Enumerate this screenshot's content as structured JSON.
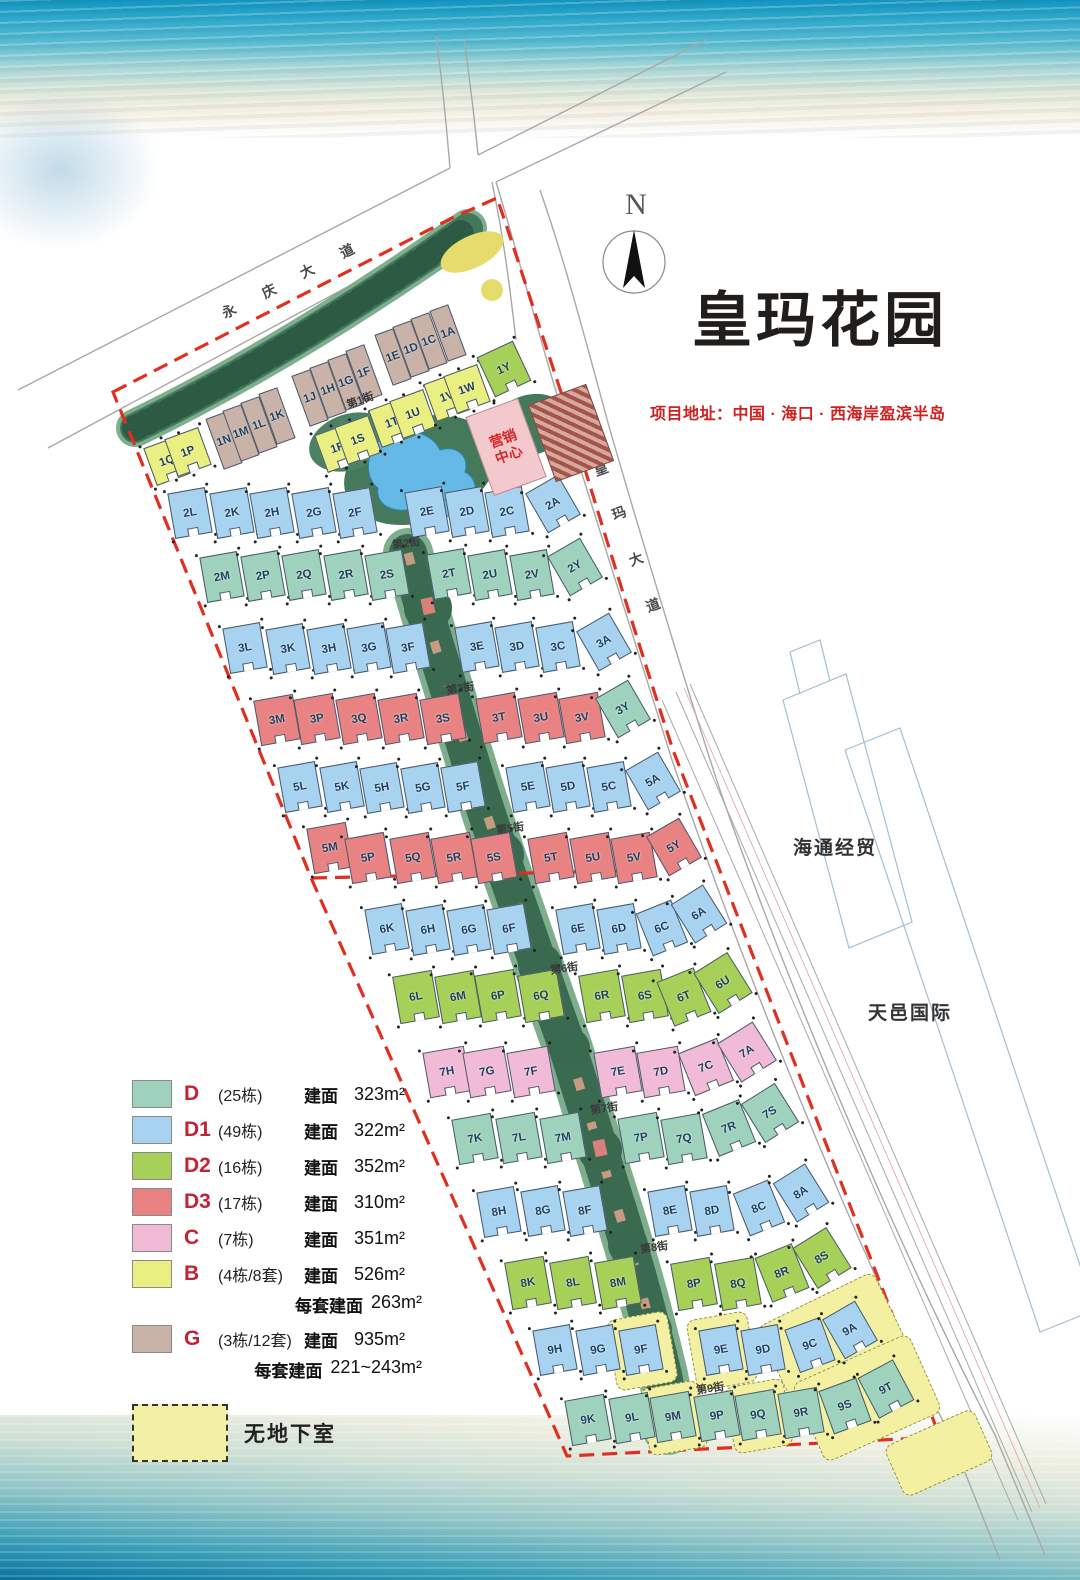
{
  "title": "皇玛花园",
  "address": "项目地址：中国 · 海口 · 西海岸盈滨半岛",
  "compass": {
    "north_label": "N"
  },
  "roads": {
    "yongqing_avenue": "永庆大道",
    "huangma_avenue": "皇玛大道"
  },
  "road_chars": [
    {
      "c": "永",
      "x": 230,
      "y": 310,
      "r": -27
    },
    {
      "c": "庆",
      "x": 270,
      "y": 290,
      "r": -27
    },
    {
      "c": "大",
      "x": 308,
      "y": 270,
      "r": -27
    },
    {
      "c": "道",
      "x": 348,
      "y": 250,
      "r": -27
    },
    {
      "c": "皇",
      "x": 602,
      "y": 468,
      "r": -20
    },
    {
      "c": "玛",
      "x": 620,
      "y": 512,
      "r": -20
    },
    {
      "c": "大",
      "x": 637,
      "y": 558,
      "r": -20
    },
    {
      "c": "道",
      "x": 654,
      "y": 604,
      "r": -20
    }
  ],
  "streets": [
    {
      "name": "第1街",
      "x": 362,
      "y": 400,
      "r": -20
    },
    {
      "name": "第2街",
      "x": 408,
      "y": 543,
      "r": -8
    },
    {
      "name": "第3街",
      "x": 462,
      "y": 688,
      "r": -8
    },
    {
      "name": "第5街",
      "x": 512,
      "y": 828,
      "r": -8
    },
    {
      "name": "第6街",
      "x": 566,
      "y": 968,
      "r": -8
    },
    {
      "name": "第7街",
      "x": 606,
      "y": 1108,
      "r": -8
    },
    {
      "name": "第8街",
      "x": 656,
      "y": 1247,
      "r": -8
    },
    {
      "name": "第9街",
      "x": 712,
      "y": 1388,
      "r": -8
    }
  ],
  "neighbors": {
    "haitong": "海通经贸",
    "tianyi": "天邑国际"
  },
  "marketing_center": {
    "line1": "营销",
    "line2": "中心"
  },
  "legend": {
    "items": [
      {
        "code": "D",
        "count": "(25栋)",
        "area_label": "建面",
        "area": "323m²",
        "color": "#9fd2bc"
      },
      {
        "code": "D1",
        "count": "(49栋)",
        "area_label": "建面",
        "area": "322m²",
        "color": "#a8d3f0"
      },
      {
        "code": "D2",
        "count": "(16栋)",
        "area_label": "建面",
        "area": "352m²",
        "color": "#a6d058"
      },
      {
        "code": "D3",
        "count": "(17栋)",
        "area_label": "建面",
        "area": "310m²",
        "color": "#e98383"
      },
      {
        "code": "C",
        "count": "(7栋)",
        "area_label": "建面",
        "area": "351m²",
        "color": "#f1bbd8"
      },
      {
        "code": "B",
        "count": "(4栋/8套)",
        "area_label": "建面",
        "area": "526m²",
        "extra_label": "每套建面",
        "extra": "263m²",
        "color": "#eaef82"
      },
      {
        "code": "G",
        "count": "(3栋/12套)",
        "area_label": "建面",
        "area": "935m²",
        "extra_label": "每套建面",
        "extra": "221~243m²",
        "color": "#c9b2a7"
      }
    ],
    "no_basement_label": "无地下室"
  },
  "building_types": {
    "D": "#9fd2bc",
    "D1": "#a8d3f0",
    "D2": "#a6d058",
    "D3": "#e98383",
    "C": "#f1bbd8",
    "B": "#eaef82",
    "G": "#c9b2a7"
  },
  "patches": [
    {
      "x": 641,
      "y": 1350,
      "w": 60,
      "h": 70,
      "r": -10
    },
    {
      "x": 721,
      "y": 1350,
      "w": 60,
      "h": 70,
      "r": -10
    },
    {
      "x": 832,
      "y": 1337,
      "w": 128,
      "h": 84,
      "r": -26
    },
    {
      "x": 673,
      "y": 1417,
      "w": 58,
      "h": 66,
      "r": -10
    },
    {
      "x": 758,
      "y": 1415,
      "w": 58,
      "h": 66,
      "r": -10
    },
    {
      "x": 866,
      "y": 1397,
      "w": 126,
      "h": 84,
      "r": -24
    },
    {
      "x": 938,
      "y": 1452,
      "w": 96,
      "h": 54,
      "r": -24
    }
  ],
  "buildings": [
    {
      "l": "1N",
      "t": "G",
      "x": 224,
      "y": 441,
      "w": 20,
      "h": 54,
      "r": -20
    },
    {
      "l": "1M",
      "t": "G",
      "x": 241,
      "y": 433,
      "w": 20,
      "h": 54,
      "r": -20
    },
    {
      "l": "1L",
      "t": "G",
      "x": 259,
      "y": 425,
      "w": 20,
      "h": 54,
      "r": -20
    },
    {
      "l": "1K",
      "t": "G",
      "x": 277,
      "y": 416,
      "w": 20,
      "h": 54,
      "r": -20
    },
    {
      "l": "1J",
      "t": "G",
      "x": 310,
      "y": 398,
      "w": 20,
      "h": 54,
      "r": -20
    },
    {
      "l": "1H",
      "t": "G",
      "x": 328,
      "y": 390,
      "w": 20,
      "h": 54,
      "r": -20
    },
    {
      "l": "1G",
      "t": "G",
      "x": 346,
      "y": 382,
      "w": 20,
      "h": 54,
      "r": -20
    },
    {
      "l": "1F",
      "t": "G",
      "x": 364,
      "y": 373,
      "w": 20,
      "h": 54,
      "r": -20
    },
    {
      "l": "1E",
      "t": "G",
      "x": 393,
      "y": 357,
      "w": 20,
      "h": 54,
      "r": -20
    },
    {
      "l": "1D",
      "t": "G",
      "x": 411,
      "y": 349,
      "w": 20,
      "h": 54,
      "r": -20
    },
    {
      "l": "1C",
      "t": "G",
      "x": 429,
      "y": 341,
      "w": 20,
      "h": 54,
      "r": -20
    },
    {
      "l": "1A",
      "t": "G",
      "x": 448,
      "y": 333,
      "w": 20,
      "h": 54,
      "r": -20
    },
    {
      "l": "1Q",
      "t": "B",
      "x": 167,
      "y": 461,
      "w": 36,
      "h": 40,
      "r": -20
    },
    {
      "l": "1P",
      "t": "B",
      "x": 188,
      "y": 452,
      "w": 36,
      "h": 40,
      "r": -20
    },
    {
      "l": "1R",
      "t": "B",
      "x": 338,
      "y": 448,
      "w": 36,
      "h": 40,
      "r": -20
    },
    {
      "l": "1S",
      "t": "B",
      "x": 358,
      "y": 440,
      "w": 36,
      "h": 40,
      "r": -20
    },
    {
      "l": "1T",
      "t": "B",
      "x": 392,
      "y": 423,
      "w": 36,
      "h": 40,
      "r": -20
    },
    {
      "l": "1U",
      "t": "B",
      "x": 413,
      "y": 414,
      "w": 36,
      "h": 40,
      "r": -20
    },
    {
      "l": "1V",
      "t": "B",
      "x": 447,
      "y": 397,
      "w": 36,
      "h": 40,
      "r": -20
    },
    {
      "l": "1W",
      "t": "B",
      "x": 467,
      "y": 389,
      "w": 36,
      "h": 40,
      "r": -20
    },
    {
      "l": "1Y",
      "t": "D2",
      "x": 504,
      "y": 369,
      "w": 40,
      "h": 44,
      "r": -25
    },
    {
      "l": "2L",
      "t": "D1",
      "x": 190,
      "y": 513
    },
    {
      "l": "2K",
      "t": "D1",
      "x": 232,
      "y": 513
    },
    {
      "l": "2H",
      "t": "D1",
      "x": 272,
      "y": 513
    },
    {
      "l": "2G",
      "t": "D1",
      "x": 314,
      "y": 513
    },
    {
      "l": "2F",
      "t": "D1",
      "x": 355,
      "y": 513
    },
    {
      "l": "2E",
      "t": "D1",
      "x": 427,
      "y": 512
    },
    {
      "l": "2D",
      "t": "D1",
      "x": 467,
      "y": 512
    },
    {
      "l": "2C",
      "t": "D1",
      "x": 507,
      "y": 512
    },
    {
      "l": "2A",
      "t": "D1",
      "x": 553,
      "y": 504,
      "r": -30
    },
    {
      "l": "2M",
      "t": "D",
      "x": 222,
      "y": 577
    },
    {
      "l": "2P",
      "t": "D",
      "x": 263,
      "y": 576
    },
    {
      "l": "2Q",
      "t": "D",
      "x": 304,
      "y": 575
    },
    {
      "l": "2R",
      "t": "D",
      "x": 346,
      "y": 575
    },
    {
      "l": "2S",
      "t": "D",
      "x": 387,
      "y": 575
    },
    {
      "l": "2T",
      "t": "D",
      "x": 449,
      "y": 574
    },
    {
      "l": "2U",
      "t": "D",
      "x": 490,
      "y": 575
    },
    {
      "l": "2V",
      "t": "D",
      "x": 532,
      "y": 575
    },
    {
      "l": "2Y",
      "t": "D",
      "x": 575,
      "y": 567,
      "r": -30
    },
    {
      "l": "3L",
      "t": "D1",
      "x": 245,
      "y": 648
    },
    {
      "l": "3K",
      "t": "D1",
      "x": 288,
      "y": 649
    },
    {
      "l": "3H",
      "t": "D1",
      "x": 329,
      "y": 649
    },
    {
      "l": "3G",
      "t": "D1",
      "x": 369,
      "y": 648
    },
    {
      "l": "3F",
      "t": "D1",
      "x": 408,
      "y": 648
    },
    {
      "l": "3E",
      "t": "D1",
      "x": 477,
      "y": 647
    },
    {
      "l": "3D",
      "t": "D1",
      "x": 517,
      "y": 647
    },
    {
      "l": "3C",
      "t": "D1",
      "x": 558,
      "y": 647
    },
    {
      "l": "3A",
      "t": "D1",
      "x": 604,
      "y": 642,
      "r": -30
    },
    {
      "l": "3M",
      "t": "D3",
      "x": 277,
      "y": 720,
      "w": 40
    },
    {
      "l": "3P",
      "t": "D3",
      "x": 317,
      "y": 719,
      "w": 40
    },
    {
      "l": "3Q",
      "t": "D3",
      "x": 359,
      "y": 719,
      "w": 40
    },
    {
      "l": "3R",
      "t": "D3",
      "x": 401,
      "y": 719,
      "w": 40
    },
    {
      "l": "3S",
      "t": "D3",
      "x": 443,
      "y": 719,
      "w": 40
    },
    {
      "l": "3T",
      "t": "D3",
      "x": 499,
      "y": 718,
      "w": 40
    },
    {
      "l": "3U",
      "t": "D3",
      "x": 541,
      "y": 718,
      "w": 40
    },
    {
      "l": "3V",
      "t": "D3",
      "x": 582,
      "y": 718,
      "w": 40
    },
    {
      "l": "3Y",
      "t": "D",
      "x": 623,
      "y": 709,
      "r": -30
    },
    {
      "l": "5L",
      "t": "D1",
      "x": 300,
      "y": 787
    },
    {
      "l": "5K",
      "t": "D1",
      "x": 342,
      "y": 787
    },
    {
      "l": "5H",
      "t": "D1",
      "x": 382,
      "y": 788
    },
    {
      "l": "5G",
      "t": "D1",
      "x": 423,
      "y": 788
    },
    {
      "l": "5F",
      "t": "D1",
      "x": 463,
      "y": 787
    },
    {
      "l": "5E",
      "t": "D1",
      "x": 528,
      "y": 787
    },
    {
      "l": "5D",
      "t": "D1",
      "x": 568,
      "y": 787
    },
    {
      "l": "5C",
      "t": "D1",
      "x": 609,
      "y": 787
    },
    {
      "l": "5A",
      "t": "D1",
      "x": 653,
      "y": 781,
      "r": -30
    },
    {
      "l": "5M",
      "t": "D3",
      "x": 330,
      "y": 848,
      "w": 40
    },
    {
      "l": "5P",
      "t": "D3",
      "x": 368,
      "y": 858,
      "w": 40
    },
    {
      "l": "5Q",
      "t": "D3",
      "x": 413,
      "y": 858,
      "w": 40
    },
    {
      "l": "5R",
      "t": "D3",
      "x": 454,
      "y": 858,
      "w": 40
    },
    {
      "l": "5S",
      "t": "D3",
      "x": 494,
      "y": 858,
      "w": 40
    },
    {
      "l": "5T",
      "t": "D3",
      "x": 551,
      "y": 858,
      "w": 40
    },
    {
      "l": "5U",
      "t": "D3",
      "x": 593,
      "y": 858,
      "w": 40
    },
    {
      "l": "5V",
      "t": "D3",
      "x": 634,
      "y": 858,
      "w": 40
    },
    {
      "l": "5Y",
      "t": "D3",
      "x": 674,
      "y": 847,
      "r": -30
    },
    {
      "l": "6K",
      "t": "D1",
      "x": 387,
      "y": 929
    },
    {
      "l": "6H",
      "t": "D1",
      "x": 428,
      "y": 930
    },
    {
      "l": "6G",
      "t": "D1",
      "x": 469,
      "y": 930
    },
    {
      "l": "6F",
      "t": "D1",
      "x": 509,
      "y": 929
    },
    {
      "l": "6E",
      "t": "D1",
      "x": 578,
      "y": 929
    },
    {
      "l": "6D",
      "t": "D1",
      "x": 619,
      "y": 929
    },
    {
      "l": "6C",
      "t": "D1",
      "x": 662,
      "y": 928,
      "r": -22
    },
    {
      "l": "6A",
      "t": "D1",
      "x": 699,
      "y": 914,
      "r": -32
    },
    {
      "l": "6L",
      "t": "D2",
      "x": 416,
      "y": 997,
      "w": 40,
      "h": 48
    },
    {
      "l": "6M",
      "t": "D2",
      "x": 458,
      "y": 997,
      "w": 40,
      "h": 48
    },
    {
      "l": "6P",
      "t": "D2",
      "x": 498,
      "y": 996,
      "w": 40,
      "h": 48
    },
    {
      "l": "6Q",
      "t": "D2",
      "x": 541,
      "y": 996,
      "w": 40,
      "h": 48
    },
    {
      "l": "6R",
      "t": "D2",
      "x": 602,
      "y": 996,
      "w": 40,
      "h": 48
    },
    {
      "l": "6S",
      "t": "D2",
      "x": 645,
      "y": 996,
      "w": 40,
      "h": 48
    },
    {
      "l": "6T",
      "t": "D2",
      "x": 684,
      "y": 997,
      "w": 40,
      "h": 48,
      "r": -22
    },
    {
      "l": "6U",
      "t": "D2",
      "x": 723,
      "y": 983,
      "w": 40,
      "h": 48,
      "r": -32
    },
    {
      "l": "7H",
      "t": "C",
      "x": 447,
      "y": 1072,
      "w": 42
    },
    {
      "l": "7G",
      "t": "C",
      "x": 487,
      "y": 1072,
      "w": 42
    },
    {
      "l": "7F",
      "t": "C",
      "x": 531,
      "y": 1072,
      "w": 42
    },
    {
      "l": "7E",
      "t": "C",
      "x": 618,
      "y": 1072,
      "w": 42
    },
    {
      "l": "7D",
      "t": "C",
      "x": 661,
      "y": 1072,
      "w": 42
    },
    {
      "l": "7C",
      "t": "C",
      "x": 706,
      "y": 1067,
      "w": 42,
      "r": -22
    },
    {
      "l": "7A",
      "t": "C",
      "x": 747,
      "y": 1052,
      "w": 42,
      "r": -32
    },
    {
      "l": "7K",
      "t": "D",
      "x": 475,
      "y": 1139,
      "w": 40
    },
    {
      "l": "7L",
      "t": "D",
      "x": 519,
      "y": 1138,
      "w": 40
    },
    {
      "l": "7M",
      "t": "D",
      "x": 563,
      "y": 1138,
      "w": 40
    },
    {
      "l": "7P",
      "t": "D",
      "x": 641,
      "y": 1138,
      "w": 40
    },
    {
      "l": "7Q",
      "t": "D",
      "x": 684,
      "y": 1139,
      "w": 40
    },
    {
      "l": "7R",
      "t": "D",
      "x": 729,
      "y": 1128,
      "w": 40,
      "r": -22
    },
    {
      "l": "7S",
      "t": "D",
      "x": 770,
      "y": 1113,
      "w": 40,
      "r": -32
    },
    {
      "l": "8H",
      "t": "D1",
      "x": 499,
      "y": 1212
    },
    {
      "l": "8G",
      "t": "D1",
      "x": 543,
      "y": 1211
    },
    {
      "l": "8F",
      "t": "D1",
      "x": 585,
      "y": 1211
    },
    {
      "l": "8E",
      "t": "D1",
      "x": 670,
      "y": 1211
    },
    {
      "l": "8D",
      "t": "D1",
      "x": 712,
      "y": 1211
    },
    {
      "l": "8C",
      "t": "D1",
      "x": 759,
      "y": 1208,
      "r": -22
    },
    {
      "l": "8A",
      "t": "D1",
      "x": 801,
      "y": 1193,
      "r": -32
    },
    {
      "l": "8K",
      "t": "D2",
      "x": 528,
      "y": 1283,
      "w": 40,
      "h": 48
    },
    {
      "l": "8L",
      "t": "D2",
      "x": 573,
      "y": 1283,
      "w": 40,
      "h": 48
    },
    {
      "l": "8M",
      "t": "D2",
      "x": 618,
      "y": 1283,
      "w": 40,
      "h": 48
    },
    {
      "l": "8P",
      "t": "D2",
      "x": 694,
      "y": 1284,
      "w": 40,
      "h": 48
    },
    {
      "l": "8Q",
      "t": "D2",
      "x": 738,
      "y": 1284,
      "w": 40,
      "h": 48
    },
    {
      "l": "8R",
      "t": "D2",
      "x": 782,
      "y": 1273,
      "w": 40,
      "h": 48,
      "r": -22
    },
    {
      "l": "8S",
      "t": "D2",
      "x": 822,
      "y": 1258,
      "w": 40,
      "h": 48,
      "r": -32
    },
    {
      "l": "9H",
      "t": "D1",
      "x": 555,
      "y": 1350
    },
    {
      "l": "9G",
      "t": "D1",
      "x": 598,
      "y": 1350
    },
    {
      "l": "9F",
      "t": "D1",
      "x": 641,
      "y": 1350
    },
    {
      "l": "9E",
      "t": "D1",
      "x": 721,
      "y": 1350
    },
    {
      "l": "9D",
      "t": "D1",
      "x": 763,
      "y": 1350
    },
    {
      "l": "9C",
      "t": "D1",
      "x": 810,
      "y": 1345,
      "r": -20
    },
    {
      "l": "9A",
      "t": "D1",
      "x": 850,
      "y": 1330,
      "r": -30
    },
    {
      "l": "9K",
      "t": "D",
      "x": 588,
      "y": 1420,
      "w": 40
    },
    {
      "l": "9L",
      "t": "D",
      "x": 632,
      "y": 1418,
      "w": 40
    },
    {
      "l": "9M",
      "t": "D",
      "x": 673,
      "y": 1417,
      "w": 40
    },
    {
      "l": "9P",
      "t": "D",
      "x": 717,
      "y": 1416,
      "w": 40
    },
    {
      "l": "9Q",
      "t": "D",
      "x": 758,
      "y": 1415,
      "w": 40
    },
    {
      "l": "9R",
      "t": "D",
      "x": 801,
      "y": 1413,
      "w": 40
    },
    {
      "l": "9S",
      "t": "D",
      "x": 845,
      "y": 1406,
      "w": 40,
      "r": -20
    },
    {
      "l": "9T",
      "t": "D",
      "x": 886,
      "y": 1389,
      "w": 40,
      "r": -28
    }
  ]
}
